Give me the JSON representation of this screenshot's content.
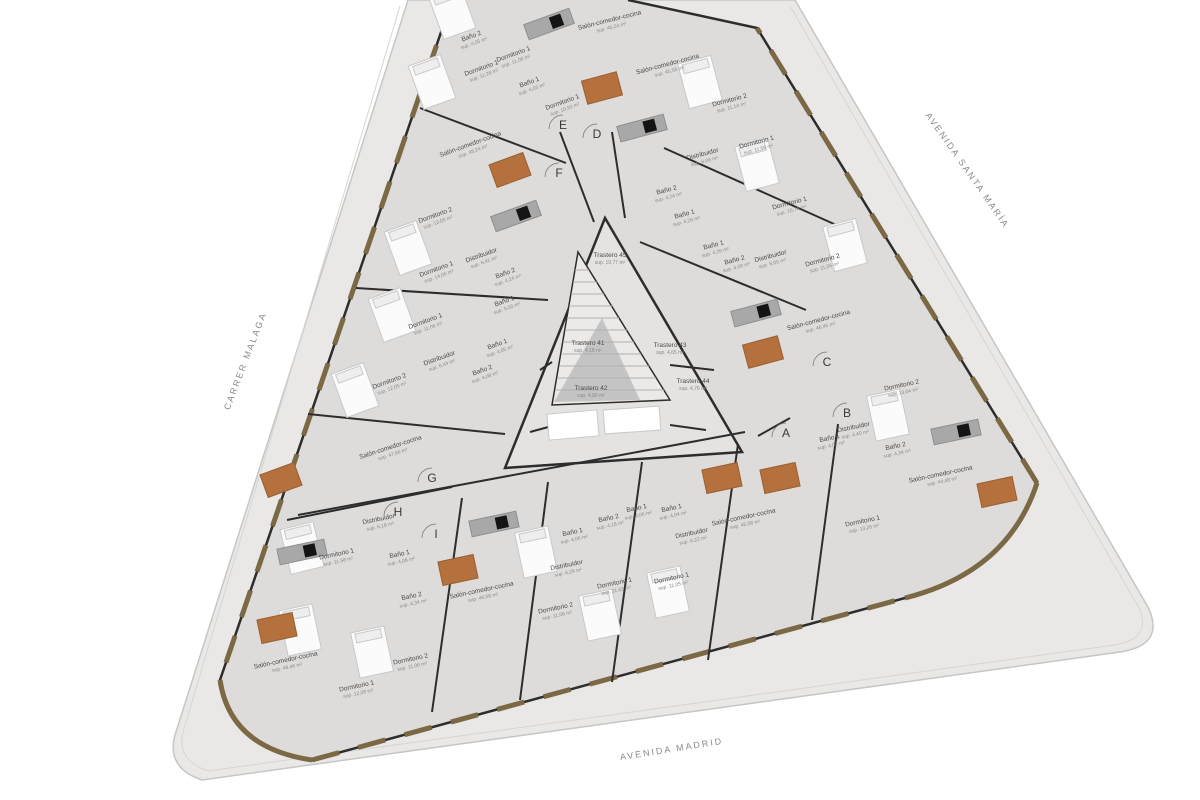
{
  "plan": {
    "type": "architectural-floor-plan",
    "colors": {
      "site": "#e9e8e6",
      "floor": "#dedcda",
      "courtyard": "#e4e3e1",
      "wall": "#2d2d2d",
      "window_frame": "#7b6844",
      "dining_table": "#b4713e",
      "kitchen_island": "#a8a8a8",
      "cooktop": "#141414",
      "label_text": "#4a4a4a",
      "street_text": "#8a8a8a"
    }
  },
  "streets": [
    {
      "name": "AVENIDA SANTA MARÍA",
      "x": 965,
      "y": 172,
      "rot": 55
    },
    {
      "name": "CARRER MALAGA",
      "x": 248,
      "y": 362,
      "rot": -69
    },
    {
      "name": "AVENIDA MADRID",
      "x": 672,
      "y": 752,
      "rot": -9
    }
  ],
  "entrances": [
    {
      "letter": "A",
      "x": 786,
      "y": 433
    },
    {
      "letter": "B",
      "x": 847,
      "y": 413
    },
    {
      "letter": "C",
      "x": 827,
      "y": 362
    },
    {
      "letter": "D",
      "x": 597,
      "y": 134
    },
    {
      "letter": "E",
      "x": 563,
      "y": 125
    },
    {
      "letter": "F",
      "x": 559,
      "y": 173
    },
    {
      "letter": "G",
      "x": 432,
      "y": 478
    },
    {
      "letter": "H",
      "x": 398,
      "y": 512
    },
    {
      "letter": "I",
      "x": 436,
      "y": 534
    }
  ],
  "rooms": [
    {
      "label": "Baño 2",
      "area": "sup. 4,05 m²",
      "x": 472,
      "y": 38,
      "rot": -20
    },
    {
      "label": "Dormitorio 1",
      "area": "sup. 11,08 m²",
      "x": 514,
      "y": 56,
      "rot": -20
    },
    {
      "label": "Dormitorio 1",
      "area": "sup. 11,28 m²",
      "x": 482,
      "y": 70,
      "rot": -20
    },
    {
      "label": "Baño 1",
      "area": "sup. 4,03 m²",
      "x": 530,
      "y": 84,
      "rot": -20
    },
    {
      "label": "Dormitorio 1",
      "area": "sup. 10,92 m²",
      "x": 563,
      "y": 104,
      "rot": -20
    },
    {
      "label": "Salón-comedor-cocina",
      "area": "sup. 45,24 m²",
      "x": 610,
      "y": 22,
      "rot": -14
    },
    {
      "label": "Salón-comedor-cocina",
      "area": "sup. 45,58 m²",
      "x": 668,
      "y": 66,
      "rot": -15
    },
    {
      "label": "Dormitorio 2",
      "area": "sup. 11,14 m²",
      "x": 730,
      "y": 102,
      "rot": -15
    },
    {
      "label": "Dormitorio 1",
      "area": "sup. 11,56 m²",
      "x": 757,
      "y": 144,
      "rot": -15
    },
    {
      "label": "Distribuidor",
      "area": "sup. 6,08 m²",
      "x": 703,
      "y": 156,
      "rot": -15
    },
    {
      "label": "Baño 2",
      "area": "sup. 4,24 m²",
      "x": 667,
      "y": 192,
      "rot": -15
    },
    {
      "label": "Baño 1",
      "area": "sup. 4,26 m²",
      "x": 685,
      "y": 216,
      "rot": -15
    },
    {
      "label": "Dormitorio 1",
      "area": "sup. 10,74 m²",
      "x": 790,
      "y": 205,
      "rot": -15
    },
    {
      "label": "Baño 1",
      "area": "sup. 4,26 m²",
      "x": 714,
      "y": 247,
      "rot": -15
    },
    {
      "label": "Baño 2",
      "area": "sup. 4,08 m²",
      "x": 735,
      "y": 262,
      "rot": -15
    },
    {
      "label": "Distribuidor",
      "area": "sup. 6,05 m²",
      "x": 771,
      "y": 258,
      "rot": -15
    },
    {
      "label": "Dormitorio 2",
      "area": "sup. 11,06 m²",
      "x": 823,
      "y": 262,
      "rot": -15
    },
    {
      "label": "Salón-comedor-cocina",
      "area": "sup. 46,45 m²",
      "x": 819,
      "y": 322,
      "rot": -15
    },
    {
      "label": "Salón-comedor-cocina",
      "area": "sup. 48,24 m²",
      "x": 471,
      "y": 146,
      "rot": -20
    },
    {
      "label": "Dormitorio 2",
      "area": "sup. 13,05 m²",
      "x": 436,
      "y": 217,
      "rot": -20
    },
    {
      "label": "Dormitorio 1",
      "area": "sup. 14,06 m²",
      "x": 437,
      "y": 271,
      "rot": -20
    },
    {
      "label": "Distribuidor",
      "area": "sup. 6,41 m²",
      "x": 482,
      "y": 257,
      "rot": -20
    },
    {
      "label": "Baño 2",
      "area": "sup. 4,24 m²",
      "x": 506,
      "y": 275,
      "rot": -20
    },
    {
      "label": "Baño 1",
      "area": "sup. 5,03 m²",
      "x": 505,
      "y": 303,
      "rot": -20
    },
    {
      "label": "Dormitorio 1",
      "area": "sup. 11,06 m²",
      "x": 426,
      "y": 323,
      "rot": -20
    },
    {
      "label": "Baño 1",
      "area": "sup. 4,05 m²",
      "x": 498,
      "y": 346,
      "rot": -20
    },
    {
      "label": "Distribuidor",
      "area": "sup. 6,44 m²",
      "x": 440,
      "y": 360,
      "rot": -20
    },
    {
      "label": "Baño 2",
      "area": "sup. 4,08 m²",
      "x": 483,
      "y": 372,
      "rot": -20
    },
    {
      "label": "Dormitorio 2",
      "area": "sup. 12,05 m²",
      "x": 390,
      "y": 383,
      "rot": -20
    },
    {
      "label": "Salón-comedor-cocina",
      "area": "sup. 47,66 m²",
      "x": 391,
      "y": 449,
      "rot": -18
    },
    {
      "label": "Trastero 45",
      "area": "sup. 10,77 m²",
      "x": 610,
      "y": 257,
      "rot": 0
    },
    {
      "label": "Trastero 41",
      "area": "sup. 4,18 m²",
      "x": 588,
      "y": 345,
      "rot": 0
    },
    {
      "label": "Trastero 43",
      "area": "sup. 4,65 m²",
      "x": 670,
      "y": 347,
      "rot": 0
    },
    {
      "label": "Trastero 42",
      "area": "sup. 4,80 m²",
      "x": 591,
      "y": 390,
      "rot": 0
    },
    {
      "label": "Trastero 44",
      "area": "sup. 4,76 m²",
      "x": 693,
      "y": 383,
      "rot": 0
    },
    {
      "label": "Distribuidor",
      "area": "sup. 6,18 m²",
      "x": 379,
      "y": 521,
      "rot": -12
    },
    {
      "label": "Dormitorio 1",
      "area": "sup. 11,58 m²",
      "x": 337,
      "y": 556,
      "rot": -12
    },
    {
      "label": "Baño 1",
      "area": "sup. 4,08 m²",
      "x": 400,
      "y": 556,
      "rot": -12
    },
    {
      "label": "Baño 2",
      "area": "sup. 4,34 m²",
      "x": 412,
      "y": 598,
      "rot": -12
    },
    {
      "label": "Salón-comedor-cocina",
      "area": "sup. 48,46 m²",
      "x": 286,
      "y": 662,
      "rot": -12
    },
    {
      "label": "Dormitorio 2",
      "area": "sup. 11,06 m²",
      "x": 411,
      "y": 661,
      "rot": -12
    },
    {
      "label": "Dormitorio 1",
      "area": "sup. 12,08 m²",
      "x": 357,
      "y": 688,
      "rot": -12
    },
    {
      "label": "Salón-comedor-cocina",
      "area": "sup. 46,58 m²",
      "x": 482,
      "y": 592,
      "rot": -12
    },
    {
      "label": "Distribuidor",
      "area": "sup. 6,29 m²",
      "x": 567,
      "y": 567,
      "rot": -12
    },
    {
      "label": "Baño 1",
      "area": "sup. 4,06 m²",
      "x": 573,
      "y": 534,
      "rot": -12
    },
    {
      "label": "Dormitorio 2",
      "area": "sup. 11,06 m²",
      "x": 556,
      "y": 610,
      "rot": -12
    },
    {
      "label": "Baño 2",
      "area": "sup. 4,18 m²",
      "x": 609,
      "y": 520,
      "rot": -12
    },
    {
      "label": "Baño 1",
      "area": "sup. 4,06 m²",
      "x": 637,
      "y": 510,
      "rot": -12
    },
    {
      "label": "Baño 1",
      "area": "sup. 4,04 m²",
      "x": 672,
      "y": 510,
      "rot": -12
    },
    {
      "label": "Distribuidor",
      "area": "sup. 6,22 m²",
      "x": 692,
      "y": 535,
      "rot": -12
    },
    {
      "label": "Dormitorio 1",
      "area": "sup. 11,62 m²",
      "x": 615,
      "y": 585,
      "rot": -12
    },
    {
      "label": "Dormitorio 1",
      "area": "sup. 11,05 m²",
      "x": 672,
      "y": 580,
      "rot": -12
    },
    {
      "label": "Salón-comedor-cocina",
      "area": "sup. 45,58 m²",
      "x": 744,
      "y": 519,
      "rot": -12
    },
    {
      "label": "Dormitorio 1",
      "area": "sup. 13,26 m²",
      "x": 863,
      "y": 523,
      "rot": -12
    },
    {
      "label": "Salón-comedor-cocina",
      "area": "sup. 44,48 m²",
      "x": 941,
      "y": 476,
      "rot": -12
    },
    {
      "label": "Baño 1",
      "area": "sup. 4,02 m²",
      "x": 830,
      "y": 440,
      "rot": -12
    },
    {
      "label": "Distribuidor",
      "area": "sup. 4,40 m²",
      "x": 854,
      "y": 429,
      "rot": -12
    },
    {
      "label": "Baño 2",
      "area": "sup. 4,34 m²",
      "x": 896,
      "y": 448,
      "rot": -12
    },
    {
      "label": "Dormitorio 2",
      "area": "sup. 13,04 m²",
      "x": 902,
      "y": 387,
      "rot": -12
    }
  ]
}
